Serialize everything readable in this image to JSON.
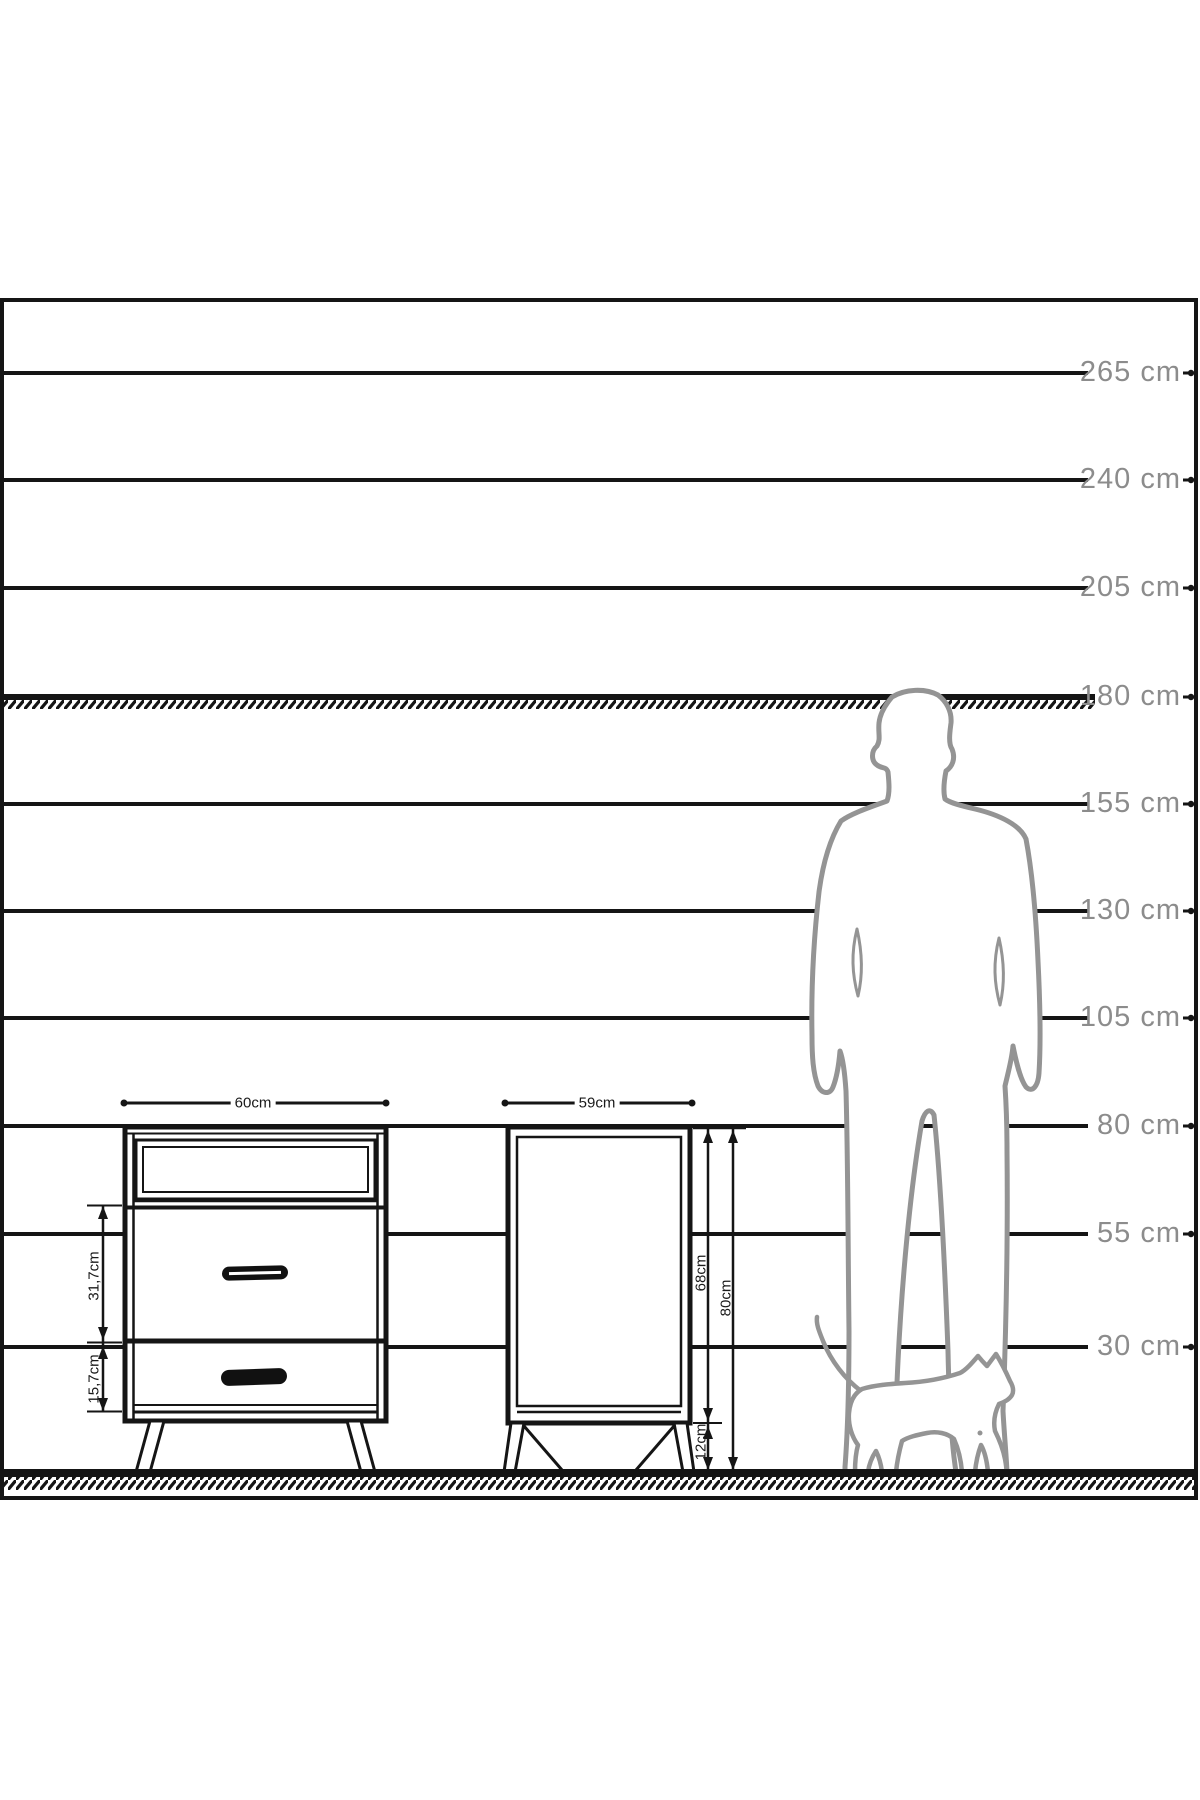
{
  "scale": {
    "unit": "cm",
    "rows": [
      {
        "text": "265 cm",
        "value": 265,
        "y": 373,
        "hatched": false
      },
      {
        "text": "240 cm",
        "value": 240,
        "y": 480,
        "hatched": false
      },
      {
        "text": "205 cm",
        "value": 205,
        "y": 588,
        "hatched": false
      },
      {
        "text": "180 cm",
        "value": 180,
        "y": 697,
        "hatched": true
      },
      {
        "text": "155 cm",
        "value": 155,
        "y": 804,
        "hatched": false
      },
      {
        "text": "130 cm",
        "value": 130,
        "y": 911,
        "hatched": false
      },
      {
        "text": "105 cm",
        "value": 105,
        "y": 1018,
        "hatched": false
      },
      {
        "text": "80 cm",
        "value": 80,
        "y": 1126,
        "hatched": false
      },
      {
        "text": "55 cm",
        "value": 55,
        "y": 1234,
        "hatched": false
      },
      {
        "text": "30 cm",
        "value": 30,
        "y": 1347,
        "hatched": false
      }
    ],
    "ground_y": 1473
  },
  "dimensions": {
    "front_width": "60cm",
    "side_width": "59cm",
    "front_upper_drawer_height": "31,7cm",
    "front_lower_drawer_height": "15,7cm",
    "side_body_height": "68cm",
    "side_total_height": "80cm",
    "side_leg_height": "12cm"
  },
  "colors": {
    "line": "#151515",
    "scale_text": "#8c8c8c",
    "dim_text": "#1a1a1a",
    "figure_outline": "#949494",
    "background": "#ffffff"
  }
}
